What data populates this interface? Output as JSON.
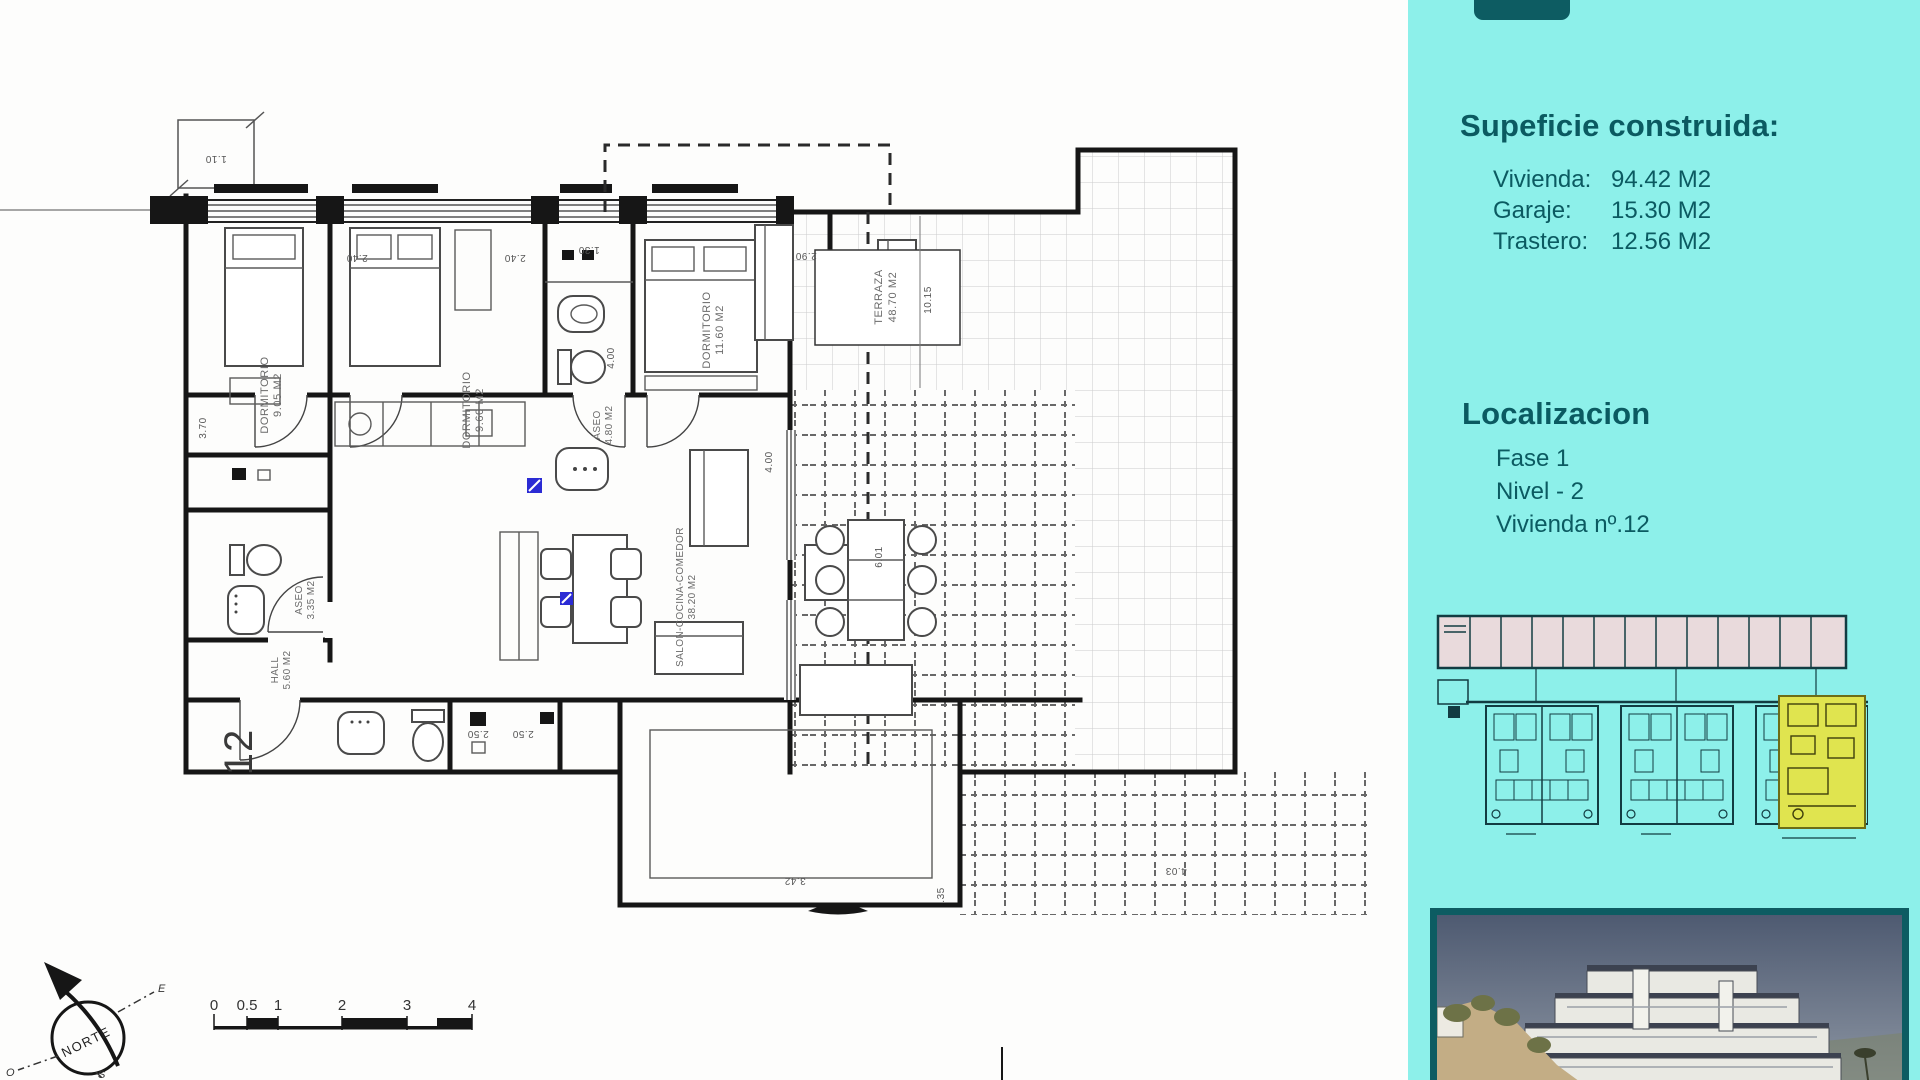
{
  "sidebar": {
    "surface": {
      "title": "Supeficie construida:",
      "items": [
        {
          "label": "Vivienda:",
          "value": "94.42 M2"
        },
        {
          "label": "Garaje:",
          "value": "15.30 M2"
        },
        {
          "label": "Trastero:",
          "value": "12.56 M2"
        }
      ]
    },
    "location": {
      "title": "Localizacion",
      "items": [
        "Fase 1",
        "Nivel - 2",
        "Vivienda nº.12"
      ]
    },
    "colors": {
      "panel": "#8df0ea",
      "text": "#0b5a61",
      "highlight_unit": "#e0e44f",
      "photo_border": "#0d5c62"
    }
  },
  "plan": {
    "unit_number": "12",
    "rooms": [
      {
        "name": "DORMITORIO",
        "area": "9.05 M2"
      },
      {
        "name": "DORMITORIO",
        "area": "9.60 M2"
      },
      {
        "name": "ASEO",
        "area": "4.80 M2"
      },
      {
        "name": "DORMITORIO",
        "area": "11.60 M2"
      },
      {
        "name": "TERRAZA",
        "area": "48.70 M2"
      },
      {
        "name": "SALON-COCINA-COMEDOR",
        "area": "38.20 M2"
      },
      {
        "name": "ASEO",
        "area": "3.35 M2"
      },
      {
        "name": "HALL",
        "area": "5.60 M2"
      }
    ],
    "dims": [
      "1.10",
      "2.40",
      "2.40",
      "1.30",
      "2.90",
      "10.15",
      "4.00",
      "4.00",
      "3.70",
      "6.01",
      "2.50",
      "2.50",
      "3.42",
      ".35",
      "4.03"
    ],
    "compass": {
      "north": "NORTE",
      "east": "E",
      "west": "O",
      "south": "S"
    },
    "scale": [
      "0",
      "0.5",
      "1",
      "2",
      "3",
      "4"
    ]
  }
}
